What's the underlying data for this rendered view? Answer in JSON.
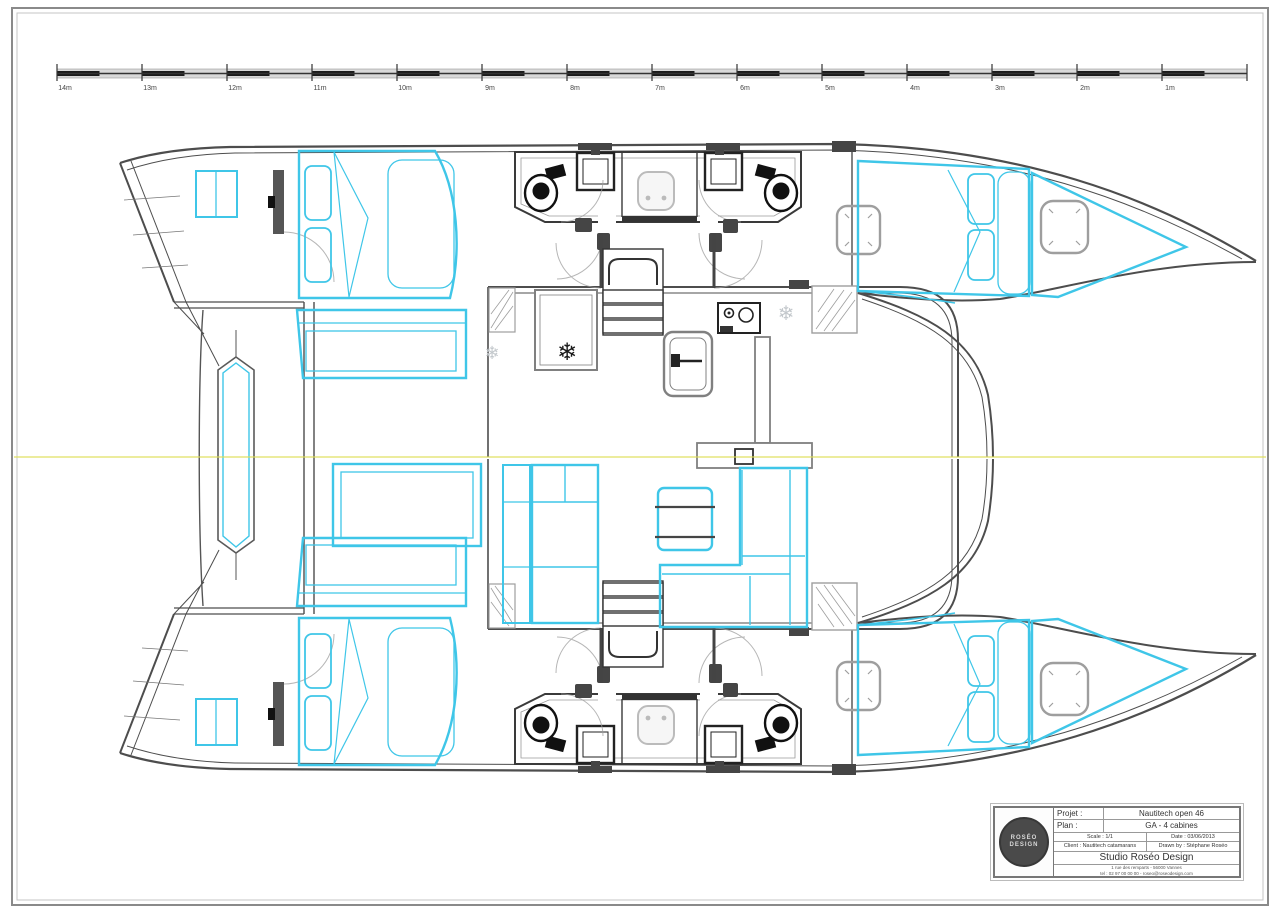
{
  "page": {
    "background": "#ffffff"
  },
  "colors": {
    "line_gray": "#4d4d4d",
    "light_gray": "#9e9e9e",
    "accent_cyan": "#3fc6e8",
    "centerline_yellow": "#dede52",
    "dark_fill": "#454545",
    "scale_black": "#1a1a1a"
  },
  "icons": {
    "snowflake": "❄"
  },
  "scale_bar": {
    "labels": [
      "14m",
      "13m",
      "12m",
      "11m",
      "10m",
      "9m",
      "8m",
      "7m",
      "6m",
      "5m",
      "4m",
      "3m",
      "2m",
      "1m"
    ]
  },
  "title_block": {
    "project_label": "Projet :",
    "project_value": "Nautitech open 46",
    "plan_label": "Plan :",
    "plan_value": "GA - 4 cabines",
    "scale_text": "Scale : 1/1",
    "date_text": "Date : 03/06/2013",
    "client_text": "Client : Nautitech catamarans",
    "drawn_text": "Drawn by : Stéphane Roséo",
    "studio_name": "Studio Roséo Design",
    "address_line": "1 rue des remparts - 56000 Vannes",
    "contact_line": "tel : 02 97 00 00 00 - roseo@roseodesign.com",
    "logo_line1": "ROSÉO",
    "logo_line2": "DESIGN"
  }
}
